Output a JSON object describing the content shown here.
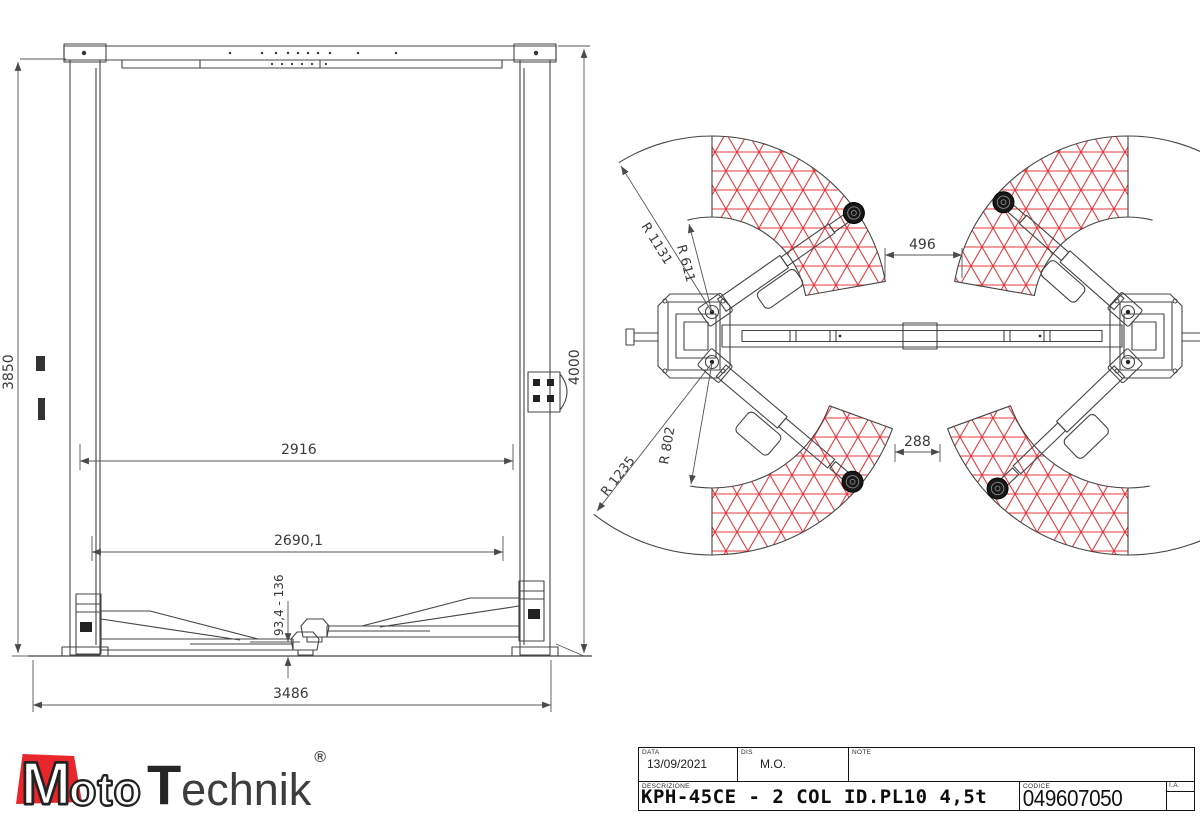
{
  "front_view": {
    "dim_height_left": "3850",
    "dim_height_right": "4000",
    "dim_width_inner": "2916",
    "dim_width_between_pads": "2690,1",
    "dim_pad_height_range": "93,4 - 136",
    "dim_width_overall": "3486"
  },
  "plan_view": {
    "dim_radius_outer_front": "R 1131",
    "dim_radius_inner_front": "R 611",
    "dim_gap_front": "496",
    "dim_radius_outer_rear": "R 1235",
    "dim_radius_inner_rear": "R 802",
    "dim_gap_rear": "288"
  },
  "title_block": {
    "data_label": "DATA",
    "data_value": "13/09/2021",
    "dis_label": "DIS",
    "dis_value": "M.O.",
    "note_label": "NOTE",
    "descrizione_label": "DESCRIZIONE",
    "descrizione_value": "KPH-45CE - 2 COL ID.PL10 4,5t",
    "codice_label": "CODICE",
    "codice_value": "049607050",
    "ia_label": "I.A."
  },
  "logo": {
    "m": "M",
    "oto": "oto",
    "t": "T",
    "echnik": "echnik",
    "registered": "®"
  },
  "colors": {
    "line": "#454545",
    "dim": "#555555",
    "hatch_red": "#e8393d",
    "logo_red": "#e8262b"
  }
}
